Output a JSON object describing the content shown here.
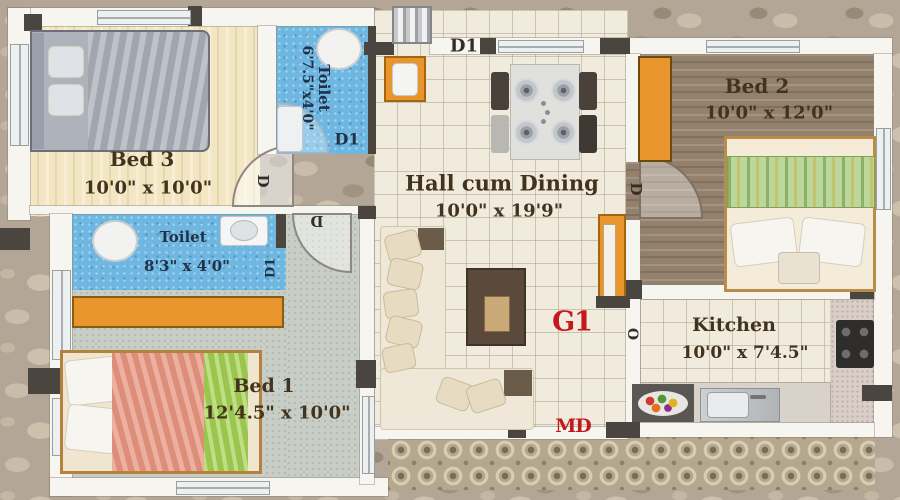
{
  "rooms": {
    "bed3": {
      "name": "Bed 3",
      "dims": "10'0\" x 10'0\""
    },
    "toilet_top": {
      "name": "Toilet",
      "dims": "6'7.5\"x4'0\""
    },
    "toilet_mid": {
      "name": "Toilet",
      "dims": "8'3\" x 4'0\""
    },
    "hall": {
      "name": "Hall cum Dining",
      "dims": "10'0\" x 19'9\""
    },
    "bed2": {
      "name": "Bed 2",
      "dims": "10'0\" x 12'0\""
    },
    "bed1": {
      "name": "Bed 1",
      "dims": "12'4.5\" x 10'0\""
    },
    "kitchen": {
      "name": "Kitchen",
      "dims": "10'0\" x 7'4.5\""
    }
  },
  "door_labels": {
    "d": "D",
    "d1": "D1",
    "main_door": "MD",
    "grill": "G1",
    "opening": "O"
  },
  "colors": {
    "accent_orange": "#e8952e",
    "label_red": "#c3181d",
    "toilet_blue": "#6fb7e0",
    "text_brown": "#42331f"
  }
}
